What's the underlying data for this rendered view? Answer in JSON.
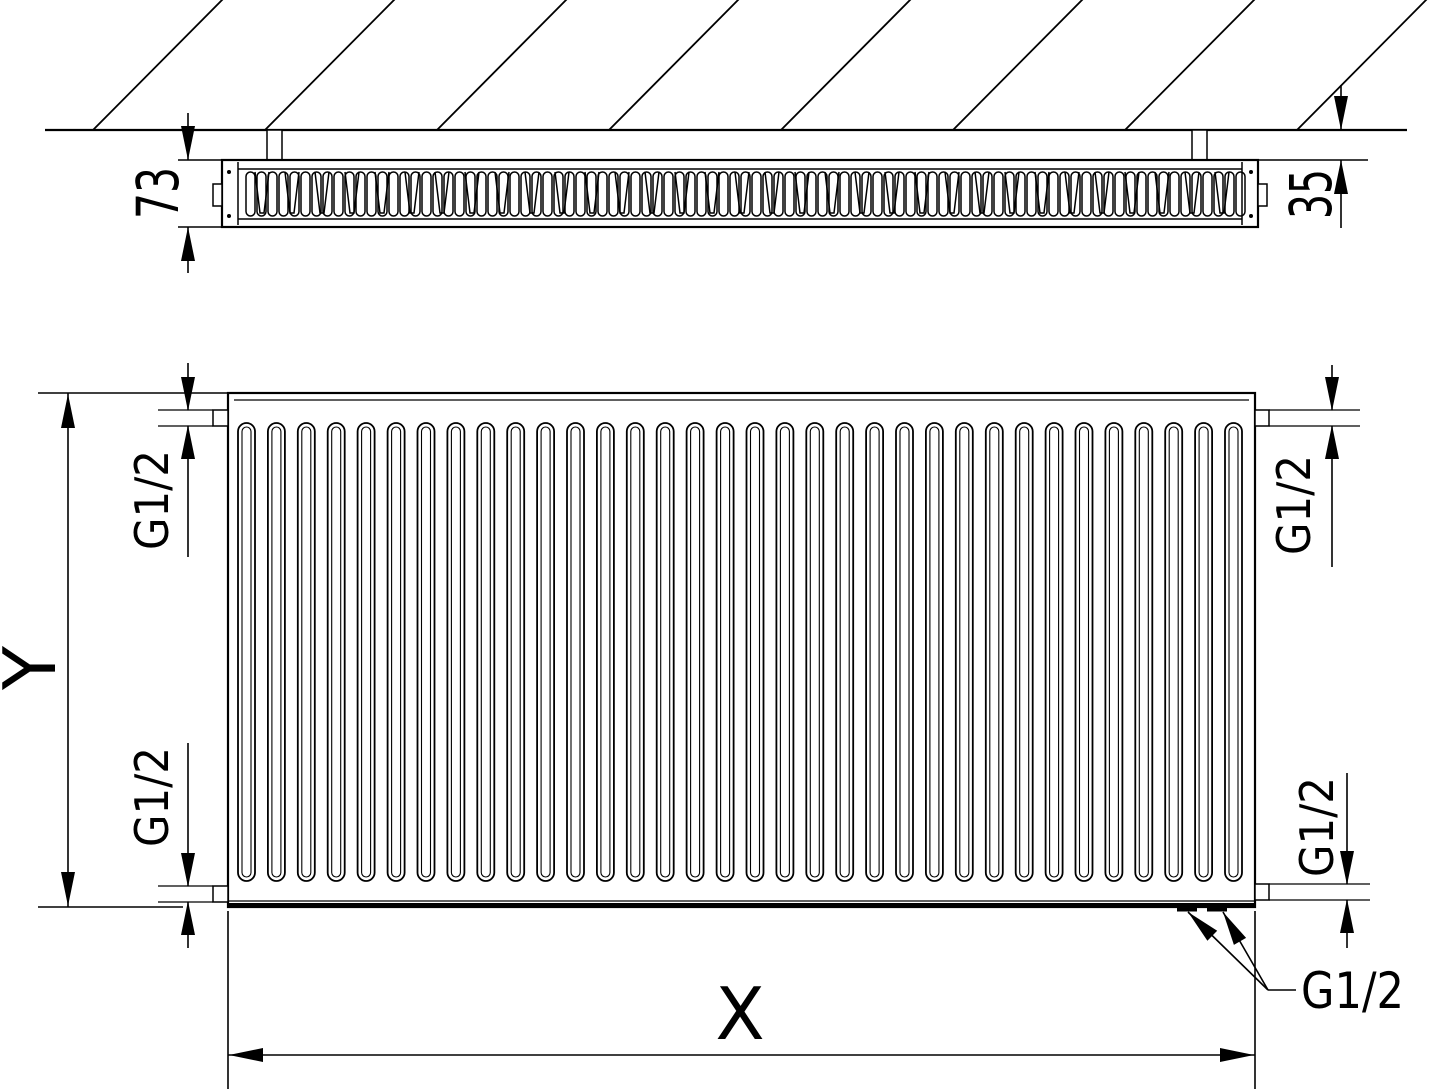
{
  "dimensions": {
    "depth": "73",
    "wall_gap": "35",
    "height": "Y",
    "width": "X",
    "conn_top_left": "G1/2",
    "conn_bottom_left": "G1/2",
    "conn_top_right": "G1/2",
    "conn_bottom_right": "G1/2",
    "conn_leader": "G1/2"
  },
  "colors": {
    "line": "#000000",
    "background": "#ffffff"
  },
  "pattern": {
    "hatch_line_count": 8,
    "top_fin_loop_count": 91,
    "top_fin_wave_count": 33,
    "front_groove_count": 34
  }
}
